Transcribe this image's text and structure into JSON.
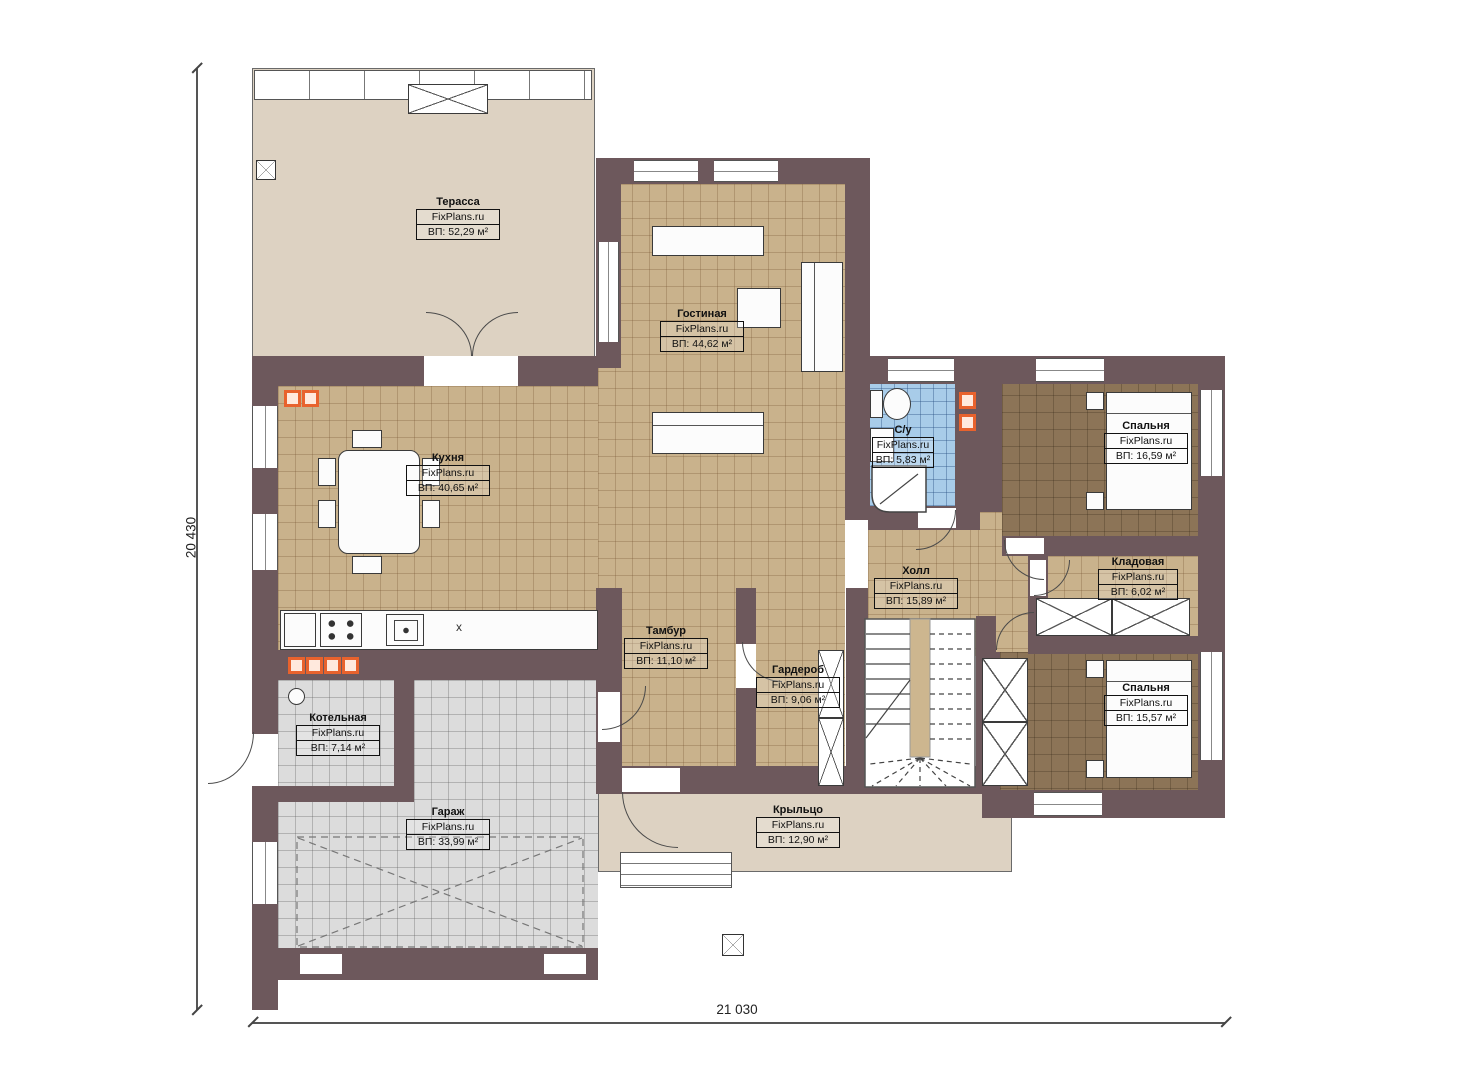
{
  "brand": "FixPlans.ru",
  "dimensions": {
    "left": "20 430",
    "bottom": "21 030"
  },
  "rooms": [
    {
      "id": "terrace",
      "name": "Терасса",
      "area": "ВП: 52,29 м²"
    },
    {
      "id": "living",
      "name": "Гостиная",
      "area": "ВП: 44,62 м²"
    },
    {
      "id": "kitchen",
      "name": "Кухня",
      "area": "ВП: 40,65 м²"
    },
    {
      "id": "bathroom",
      "name": "С/у",
      "area": "ВП: 5,83 м²"
    },
    {
      "id": "bedroom1",
      "name": "Спальня",
      "area": "ВП: 16,59 м²"
    },
    {
      "id": "storage",
      "name": "Кладовая",
      "area": "ВП: 6,02 м²"
    },
    {
      "id": "bedroom2",
      "name": "Спальня",
      "area": "ВП: 15,57 м²"
    },
    {
      "id": "hall",
      "name": "Холл",
      "area": "ВП: 15,89 м²"
    },
    {
      "id": "tambour",
      "name": "Тамбур",
      "area": "ВП: 11,10 м²"
    },
    {
      "id": "wardrobe",
      "name": "Гардероб",
      "area": "ВП: 9,06 м²"
    },
    {
      "id": "boiler",
      "name": "Котельная",
      "area": "ВП: 7,14 м²"
    },
    {
      "id": "garage",
      "name": "Гараж",
      "area": "ВП: 33,99 м²"
    },
    {
      "id": "porch",
      "name": "Крыльцо",
      "area": "ВП: 12,90 м²"
    }
  ],
  "misc": {
    "sink_mark": "x"
  },
  "colors": {
    "wall": "#6d585c",
    "tan": "#c9b28c",
    "brown": "#8c7457",
    "blue": "#a8cce9",
    "gray": "#dcdcdc",
    "beige": "#ddd2c2",
    "accent": "#e8622d"
  }
}
